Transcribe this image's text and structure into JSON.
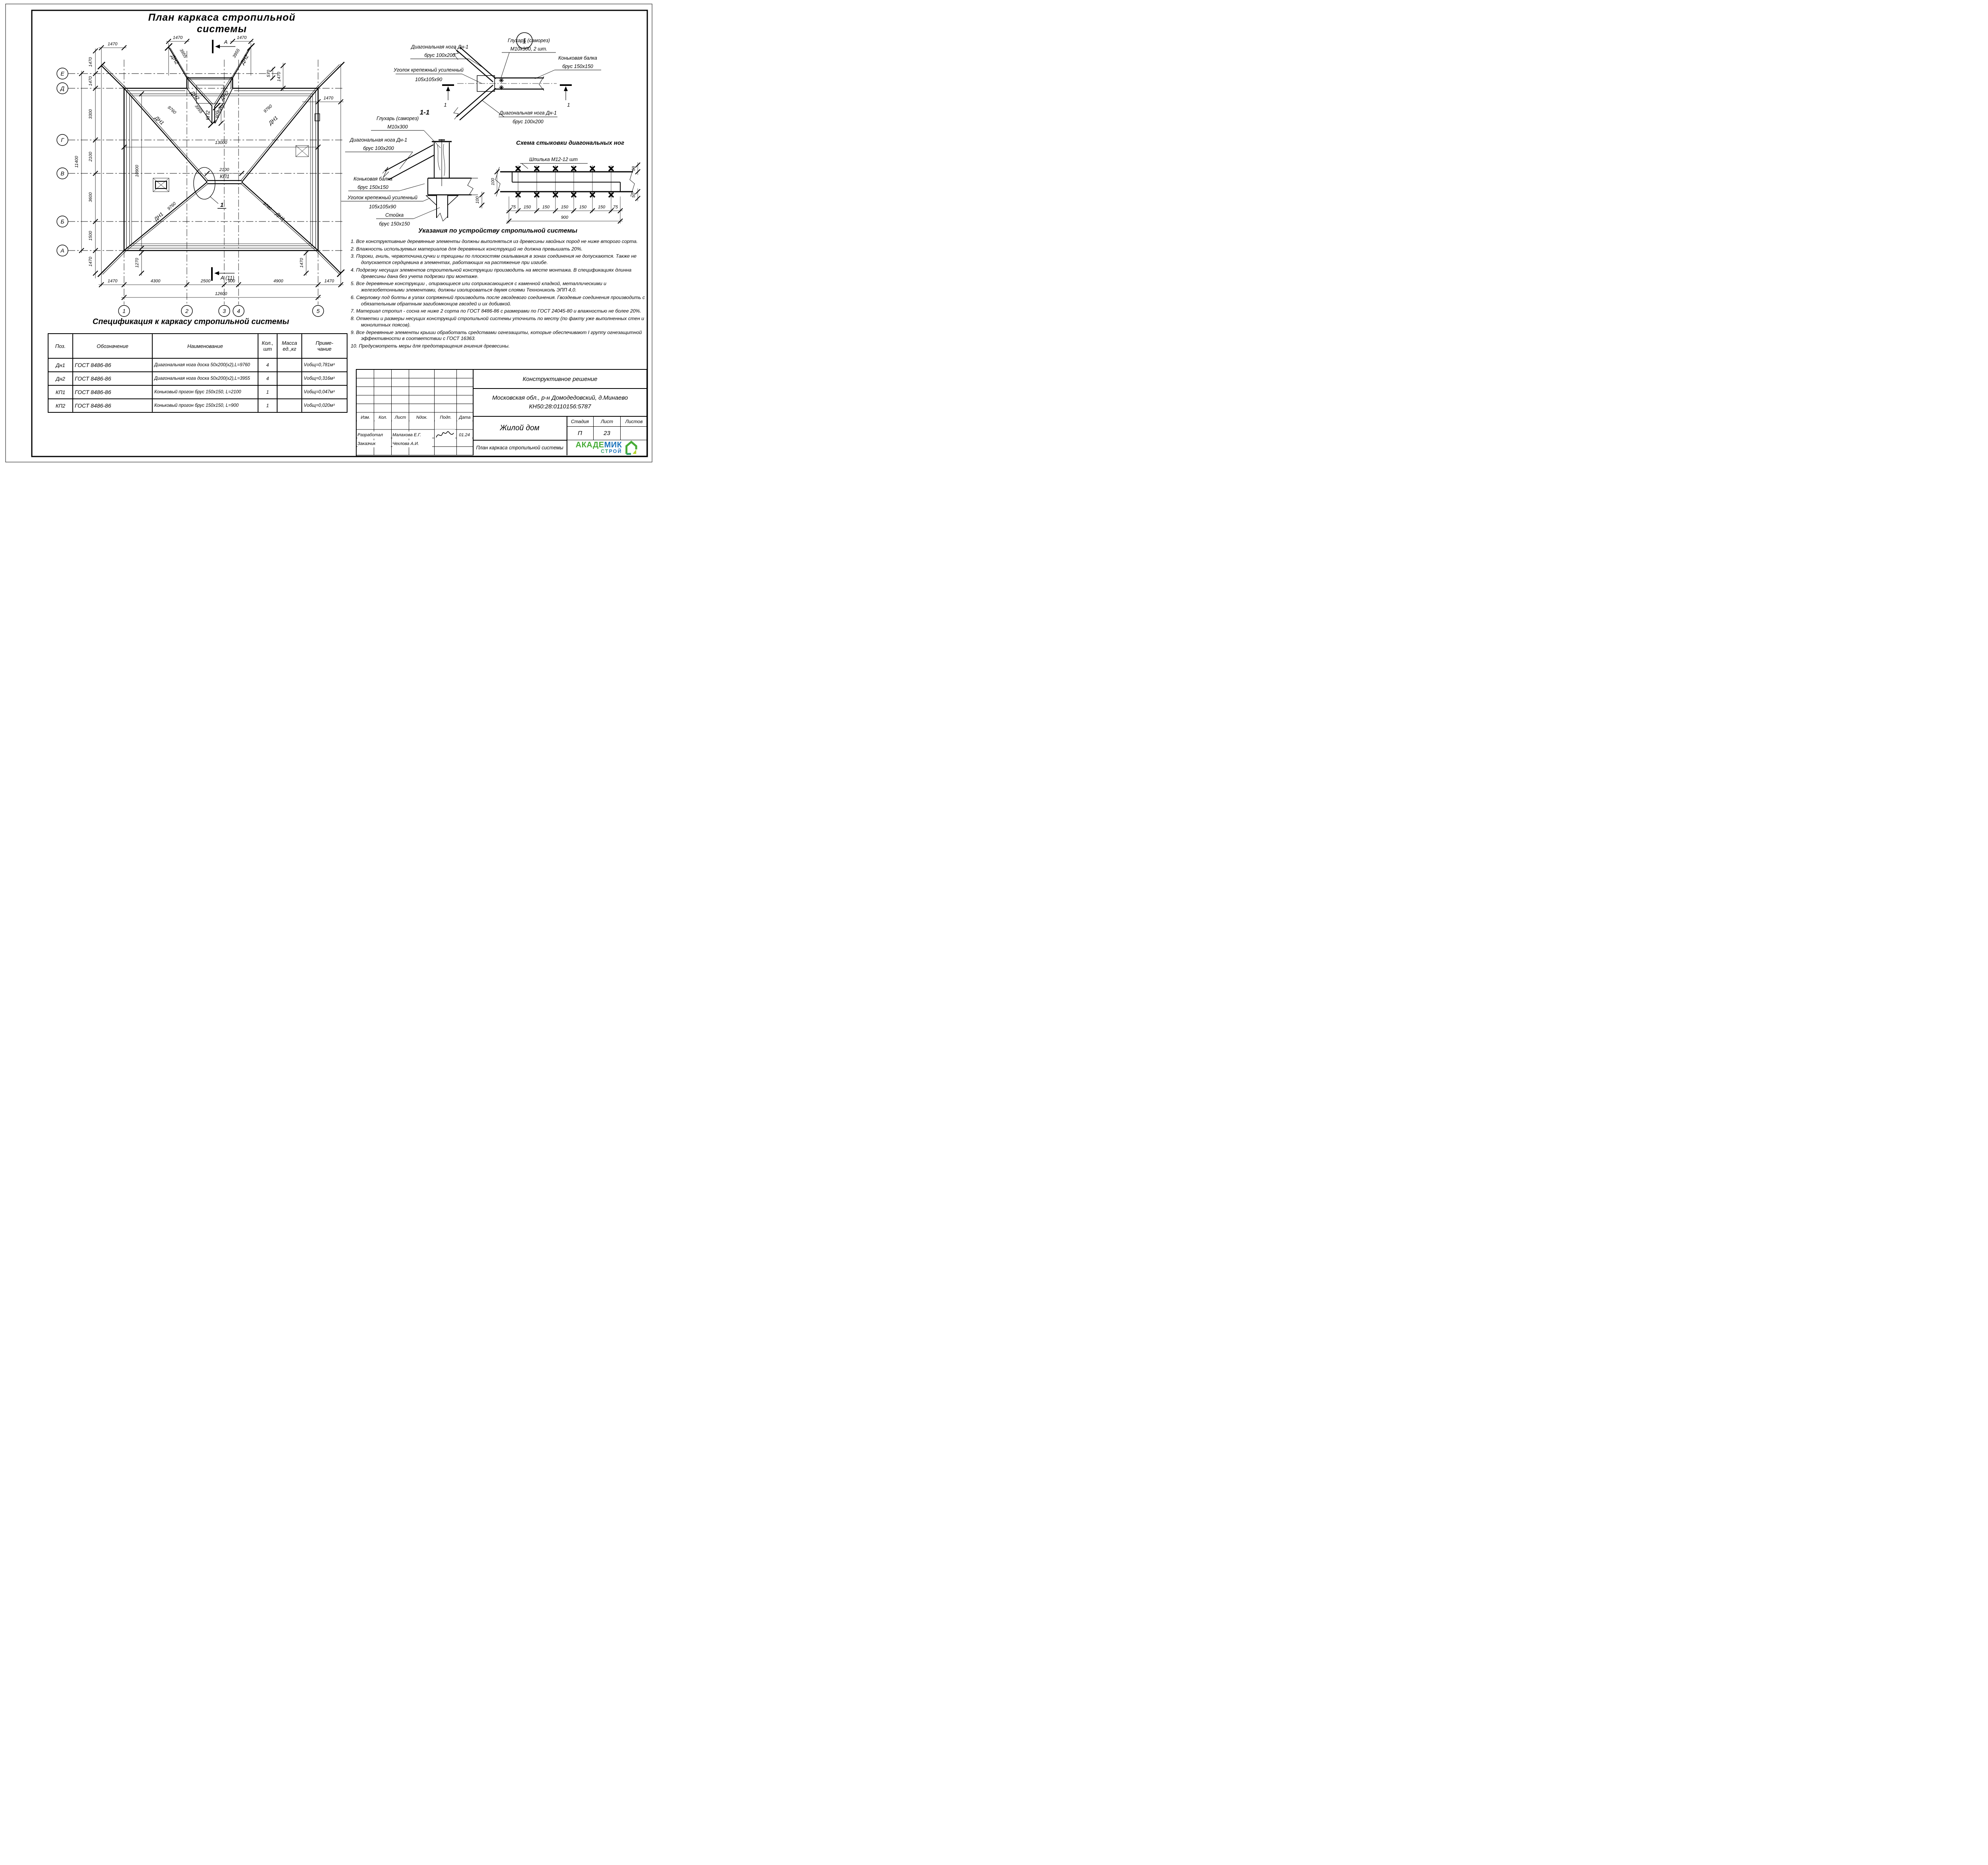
{
  "plan": {
    "title": "План каркаса стропильной системы",
    "row_axes": [
      "Е",
      "Д",
      "Г",
      "В",
      "Б",
      "А"
    ],
    "col_axes": [
      "1",
      "2",
      "3",
      "4",
      "5"
    ],
    "dims": {
      "v1470": "1470",
      "v3300": "3300",
      "v2100": "2100",
      "v3600": "3600",
      "v1500": "1500",
      "v11400": "11400",
      "v4300": "4300",
      "v2500": "2500",
      "v900": "900",
      "v4900": "4900",
      "v12600": "12600",
      "v13000": "13000",
      "v10900": "10900",
      "v1270": "1270",
      "v570": "570"
    },
    "members": {
      "dn1": "ДН1",
      "dn2": "ДН2",
      "kp1": "КП1",
      "kp2": "КП2",
      "len1": "9760",
      "len2": "3955"
    },
    "callout": "1",
    "section_top": "А",
    "section_bottom": "А (11)"
  },
  "detail1": {
    "num": "1",
    "cut": "1",
    "leg1": "Диагональная нога Дн-1",
    "leg1_size": "брус 100х200",
    "screw": "Глухарь (саморез)",
    "screw_size": "М10х300, 2 шт.",
    "ridge": "Коньковая балка",
    "ridge_size": "брус 150х150",
    "bracket": "Уголок крепежный усиленный",
    "bracket_size": "105х105х90",
    "leg2": "Диагональная нога Дн-1",
    "leg2_size": "брус 100х200"
  },
  "section11": {
    "title": "1-1",
    "screw": "Глухарь (саморез)",
    "screw_size": "М10х300",
    "leg": "Диагональная нога Дн-1",
    "leg_size": "брус 100х200",
    "ridge": "Коньковая балка",
    "ridge_size": "брус 150х150",
    "bracket": "Уголок крепежный усиленный",
    "bracket_size": "105х105х90",
    "post": "Стойка",
    "post_size": "брус 150х150",
    "dim100": "100"
  },
  "scheme": {
    "title": "Схема стыковки диагональных ног",
    "stud": "Шпилька М12-12 шт",
    "d75": "75",
    "d150": "150",
    "d900": "900",
    "d50": "50",
    "d100": "100"
  },
  "notes": {
    "title": "Указания по устройству стропильной системы",
    "items": [
      "1. Все конструктивные деревянные элементы должны выполняться из древесины хвойных пород не ниже второго сорта.",
      "2. Влажность используемых материалов для деревянных конструкций не должна превышать 20%.",
      "3. Пороки, гниль, червоточина,сучки и трещины по плоскостям скалывания в зонах соединения не допускаются. Также не допускается сердцевина в элементах, работающих на растяжение при изгибе.",
      "4. Подрезку несущих элементов строительной конструкции производить на месте монтажа. В спецификациях длинна древесины дана без учета подрезки при монтаже.",
      "5. Все деревянные конструкции , опирающиеся или соприкасающиеся с каменной кладкой, металлическими и железобетонными элементами, должны изолироваться двумя слоями Технониколь ЭПП 4,0.",
      "6. Сверловку под болты в узлах сопряжений производить после гвоздевого соединения. Гвоздевые соединения производить с обязательным обратным загибомконцов гвоздей и их добивкой.",
      "7. Материал стропил - сосна не ниже 2 сорта по ГОСТ 8486-86 с размерами по ГОСТ 24045-80 и влажностью не более 20%.",
      "8. Отметки и размеры несущих конструкций стропильной системы уточнить по месту (по факту уже выполненных стен и монолитных поясов).",
      "9. Все деревянные элементы крыши обработать средствами огнезащиты, которые обеспечивают I группу огнезащитной эффективности в соответствии с ГОСТ 16363.",
      "10. Предусмотреть меры для предотвращения гниения древесины."
    ]
  },
  "spec": {
    "title": "Спецификация к каркасу стропильной системы",
    "h": {
      "pos": "Поз.",
      "des": "Обозначение",
      "name": "Наименование",
      "qty1": "Кол.,",
      "qty2": "шт",
      "mass1": "Масса",
      "mass2": "ед.,кг",
      "note1": "Приме-",
      "note2": "чание"
    },
    "rows": [
      {
        "pos": "Дн1",
        "des": "ГОСТ 8486-86",
        "name": "Диагональная нога доска 50х200(х2),L=9760",
        "qty": "4",
        "mass": "",
        "note": "Vобщ=0,781м³"
      },
      {
        "pos": "Дн2",
        "des": "ГОСТ 8486-86",
        "name": "Диагональная нога доска 50х200(х2),L=3955",
        "qty": "4",
        "mass": "",
        "note": "Vобщ=0,316м³"
      },
      {
        "pos": "КП1",
        "des": "ГОСТ 8486-86",
        "name": "Коньковый прогон брус 150х150, L=2100",
        "qty": "1",
        "mass": "",
        "note": "Vобщ=0,047м³"
      },
      {
        "pos": "КП2",
        "des": "ГОСТ 8486-86",
        "name": "Коньковый прогон брус 150х150, L=900",
        "qty": "1",
        "mass": "",
        "note": "Vобщ=0,020м³"
      }
    ]
  },
  "titleblock": {
    "doc_type": "Конструктивное решение",
    "location1": "Московская обл., р-н Домодедовский, д.Минаево",
    "location2": "КН50:28:0110156:5787",
    "col_izm": "Изм.",
    "col_kol": "Кол.",
    "col_list": "Лист",
    "col_ndok": "Nдок.",
    "col_podp": "Подп.",
    "col_data": "Дата",
    "developed_label": "Разработал",
    "developed_name": "Малахова Е.Г.",
    "developed_date": "01.24",
    "customer_label": "Заказчик",
    "customer_name": "Чехлова А.И.",
    "object": "Жилой дом",
    "stage_label": "Стадия",
    "sheet_label": "Лист",
    "sheets_label": "Листов",
    "stage": "П",
    "sheet": "23",
    "sheets": "",
    "drawing_title": "План каркаса стропильной системы"
  },
  "logo": {
    "p1": "АКАДЕ",
    "p2": "МИК",
    "p3": "СТ",
    "p4": "РОЙ"
  },
  "colors": {
    "logo_green": "#46ab36",
    "logo_blue": "#1d74bc",
    "logo_teal": "#33a06a",
    "logo_lime": "#b5d327"
  }
}
